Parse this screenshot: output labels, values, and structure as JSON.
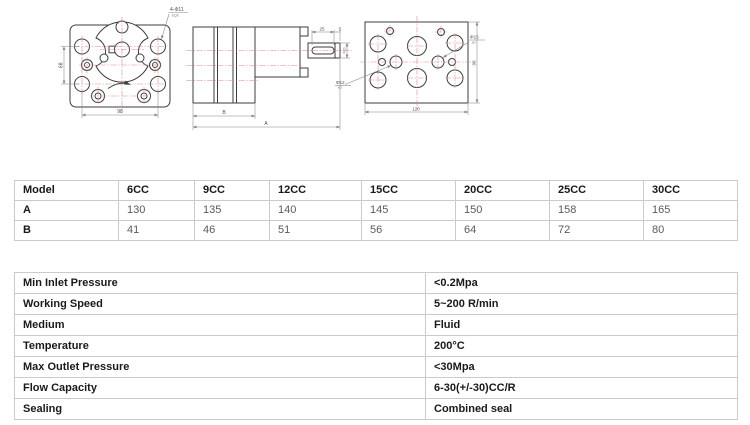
{
  "drawing": {
    "front": {
      "holes_label": "4-Φ11",
      "holes_sub": "EQS",
      "width": "98",
      "height": "68"
    },
    "side": {
      "key_length": "25",
      "key_end": "5",
      "shaft_dia": "Φ20",
      "body_label": "B",
      "total_label": "A"
    },
    "back": {
      "width": "120",
      "height": "90",
      "port_right": "Φ15",
      "port_right_sub": "H7",
      "port_left": "Φ12",
      "port_left_sub": "H7"
    },
    "colors": {
      "outline": "#3d3d3d",
      "centerline": "#dc8a8a",
      "dimension": "#858585"
    }
  },
  "dimensions_table": {
    "header": [
      "Model",
      "6CC",
      "9CC",
      "12CC",
      "15CC",
      "20CC",
      "25CC",
      "30CC"
    ],
    "rows": [
      {
        "label": "A",
        "values": [
          "130",
          "135",
          "140",
          "145",
          "150",
          "158",
          "165"
        ]
      },
      {
        "label": "B",
        "values": [
          "41",
          "46",
          "51",
          "56",
          "64",
          "72",
          "80"
        ]
      }
    ]
  },
  "specs_table": {
    "rows": [
      {
        "label": "Min Inlet Pressure",
        "value": "<0.2Mpa"
      },
      {
        "label": "Working Speed",
        "value": "5~200 R/min"
      },
      {
        "label": "Medium",
        "value": "Fluid"
      },
      {
        "label": "Temperature",
        "value": "200°C"
      },
      {
        "label": "Max Outlet Pressure",
        "value": "<30Mpa"
      },
      {
        "label": "Flow Capacity",
        "value": "6-30(+/-30)CC/R"
      },
      {
        "label": "Sealing",
        "value": "Combined seal"
      }
    ]
  }
}
